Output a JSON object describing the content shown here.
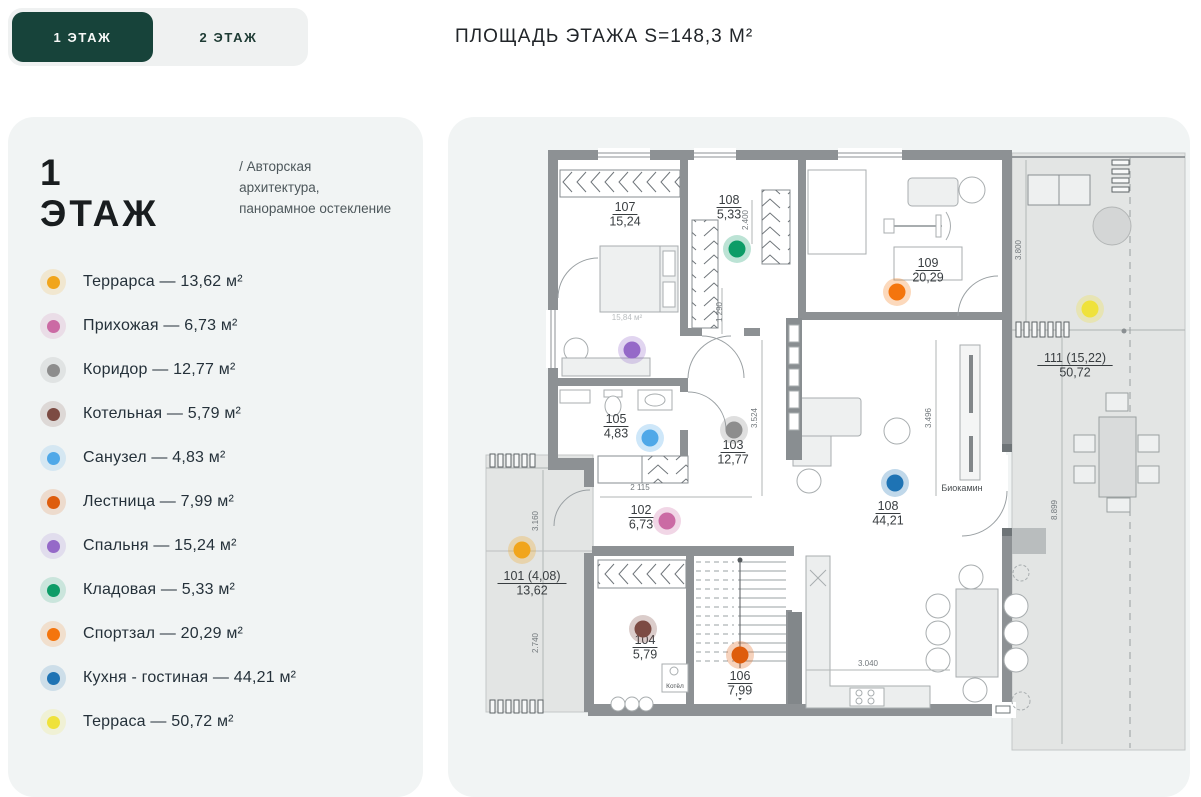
{
  "tabs": {
    "floor1": "1 ЭТАЖ",
    "floor2": "2 ЭТАЖ"
  },
  "header": {
    "area_label": "ПЛОЩАДЬ ЭТАЖА S=148,3 М²"
  },
  "panel": {
    "title": "1 ЭТАЖ",
    "subtitle_line1": "/ Авторская архитектура,",
    "subtitle_line2": "панорамное остекление",
    "legend": [
      {
        "key": "terrace-small",
        "label": "Террарса — 13,62 м²",
        "color": "#F1A51C",
        "dot": {
          "x": 522,
          "y": 550
        }
      },
      {
        "key": "hallway",
        "label": "Прихожая — 6,73 м²",
        "color": "#CB6AA4",
        "dot": {
          "x": 667,
          "y": 521
        }
      },
      {
        "key": "corridor",
        "label": "Коридор — 12,77 м²",
        "color": "#8D8D8D",
        "dot": {
          "x": 734,
          "y": 430
        }
      },
      {
        "key": "boiler-room",
        "label": "Котельная — 5,79 м²",
        "color": "#7C4B43",
        "dot": {
          "x": 643,
          "y": 629
        }
      },
      {
        "key": "bathroom",
        "label": "Санузел — 4,83 м²",
        "color": "#4FA8E8",
        "dot": {
          "x": 650,
          "y": 438
        }
      },
      {
        "key": "stairs",
        "label": "Лестница — 7,99 м²",
        "color": "#DE5D0D",
        "dot": {
          "x": 740,
          "y": 655
        }
      },
      {
        "key": "bedroom",
        "label": "Спальня — 15,24 м²",
        "color": "#9569C8",
        "dot": {
          "x": 632,
          "y": 350
        }
      },
      {
        "key": "storage",
        "label": "Кладовая — 5,33 м²",
        "color": "#0D9C67",
        "dot": {
          "x": 737,
          "y": 249
        }
      },
      {
        "key": "gym",
        "label": "Спортзал — 20,29 м²",
        "color": "#F4750D",
        "dot": {
          "x": 897,
          "y": 292
        }
      },
      {
        "key": "kitchen-living",
        "label": "Кухня - гостиная — 44,21 м²",
        "color": "#1E73B4",
        "dot": {
          "x": 895,
          "y": 483
        }
      },
      {
        "key": "terrace-large",
        "label": "Терраса — 50,72 м²",
        "color": "#EFE23B",
        "dot": {
          "x": 1090,
          "y": 309
        }
      }
    ]
  },
  "plan": {
    "rooms": [
      {
        "num": "107",
        "area": "15,24",
        "x": 625,
        "y": 211
      },
      {
        "num": "108",
        "area": "5,33",
        "x": 729,
        "y": 204
      },
      {
        "num": "109",
        "area": "20,29",
        "x": 928,
        "y": 267
      },
      {
        "num": "111 (15,22)",
        "area": "50,72",
        "x": 1075,
        "y": 362
      },
      {
        "num": "103",
        "area": "12,77",
        "x": 733,
        "y": 449
      },
      {
        "num": "105",
        "area": "4,83",
        "x": 616,
        "y": 423
      },
      {
        "num": "102",
        "area": "6,73",
        "x": 641,
        "y": 514
      },
      {
        "num": "101 (4,08)",
        "area": "13,62",
        "x": 532,
        "y": 580
      },
      {
        "num": "104",
        "area": "5,79",
        "x": 645,
        "y": 644
      },
      {
        "num": "106",
        "area": "7,99",
        "x": 740,
        "y": 680
      },
      {
        "num": "108",
        "area": "44,21",
        "x": 888,
        "y": 510
      }
    ],
    "dimensions": [
      {
        "text": "3.800",
        "x": 1021,
        "y": 250,
        "rot": -90
      },
      {
        "text": "8.899",
        "x": 1057,
        "y": 510,
        "rot": -90
      },
      {
        "text": "2.400",
        "x": 748,
        "y": 220,
        "rot": -90
      },
      {
        "text": "1 290",
        "x": 722,
        "y": 312,
        "rot": -90
      },
      {
        "text": "3.524",
        "x": 757,
        "y": 418,
        "rot": -90
      },
      {
        "text": "3.496",
        "x": 931,
        "y": 418,
        "rot": -90
      },
      {
        "text": "2 115",
        "x": 640,
        "y": 490,
        "rot": 0
      },
      {
        "text": "3.160",
        "x": 538,
        "y": 521,
        "rot": -90
      },
      {
        "text": "2.740",
        "x": 538,
        "y": 643,
        "rot": -90
      },
      {
        "text": "3.040",
        "x": 868,
        "y": 666,
        "rot": 0
      }
    ],
    "annotations": [
      {
        "text": "Биокамин",
        "x": 962,
        "y": 491,
        "size": 9,
        "cls": "note"
      },
      {
        "text": "Котёл",
        "x": 675,
        "y": 688,
        "size": 6.5,
        "cls": "note"
      },
      {
        "text": "15,84 м²",
        "x": 627,
        "y": 320,
        "size": 8,
        "cls": "faint"
      }
    ]
  },
  "colors": {
    "accent_green": "#17433a",
    "card_bg": "#f1f4f4",
    "wall": "#8d9194"
  }
}
